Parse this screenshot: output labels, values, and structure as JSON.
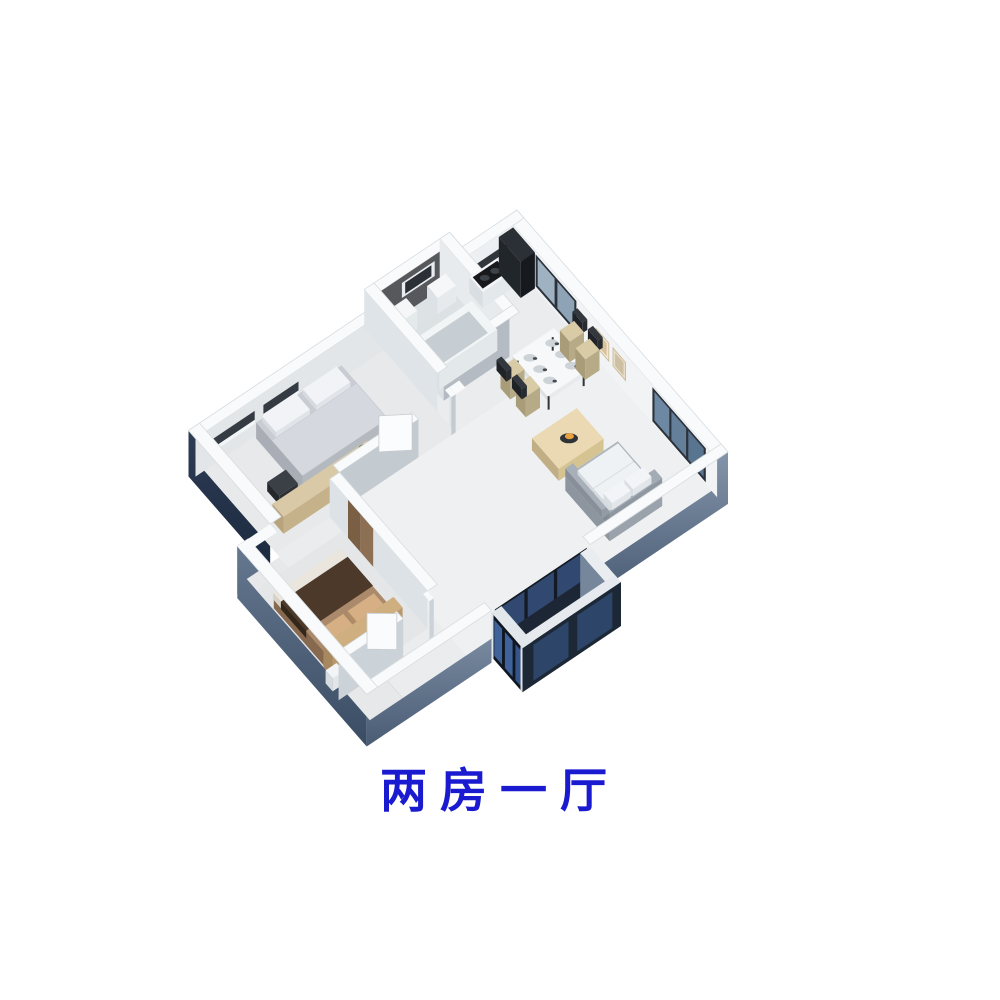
{
  "caption": {
    "text": "两房一厅",
    "color": "#1a1ad0"
  },
  "scene": {
    "description": "3D isometric rendering of a two-bedroom one-living-room apartment floor plan"
  },
  "colors": {
    "background": "#ffffff",
    "wall_top": "#f8fafb",
    "wall_interior": "#f1f3f5",
    "wall_shade": "#c3cad0",
    "floor": "#eaecee",
    "exterior_jog": "#41536b",
    "bath_accent": "#56585c",
    "window_frame": "#2c323a",
    "window_glass": "#9fb2c2",
    "sofa_grey": "#aeb6be",
    "cushion_white": "#eff2f4",
    "bed_grey": "#c9cdd3",
    "bed2_brown": "#ab8a6b",
    "blanket_brown": "#4c392a",
    "wood_tan": "#d9c9a6",
    "coffee_table_tan": "#ead9b2",
    "wardrobe_brown": "#7b5f45",
    "balcony_face_dark": "#10161f",
    "balcony_glass_blue": "#40629a",
    "decor_orange": "#e8a13c",
    "plant_green": "#5a7a4a",
    "chair_seat_tan": "#d8cba6",
    "chair_frame_dark": "#33383e",
    "caption_blue": "#1a1ad0"
  }
}
